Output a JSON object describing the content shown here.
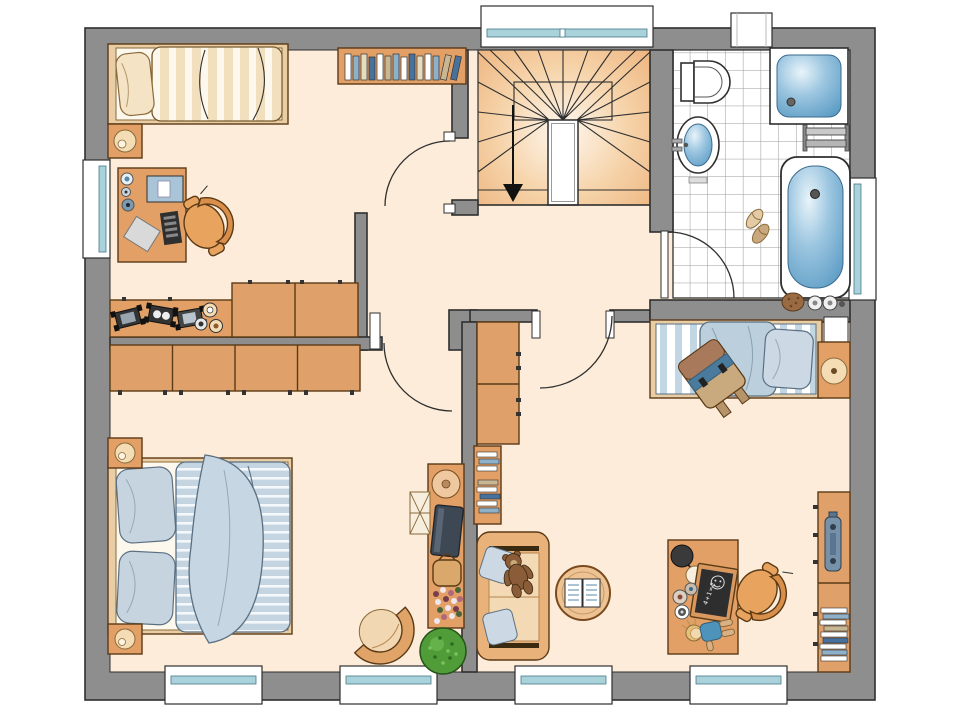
{
  "diagram": {
    "type": "architectural-floor-plan",
    "floor": "upper-floor",
    "chalkboard": {
      "text": "4+1=2"
    },
    "palette": {
      "wall_gray": "#8e8e8e",
      "outline": "#2f2f2f",
      "floor_peach": "#fcecd9",
      "furniture_wood": "#e2a066",
      "wardrobe_wood": "#dfa06a",
      "wood_outline": "#5b3a16",
      "textile_blue": "#c4d4e1",
      "textile_beige": "#f2dfbe",
      "water_blue": "#4e93bf",
      "window_glass": "#a9d2da",
      "stair_orange": "#eaa96f",
      "plant_green": "#4f9c39",
      "chalkboard_black": "#2e2e2e"
    },
    "rooms": {
      "bedroom_top_left": {
        "furniture": [
          "single-bed",
          "pillow",
          "nightstand",
          "lamp",
          "desk",
          "computer-monitor",
          "keyboard",
          "office-chair",
          "wall-bookshelf",
          "toy-sideboard",
          "toy-cars",
          "cabinets"
        ]
      },
      "stair_hall": {
        "furniture": [
          "winder-staircase",
          "stair-landing",
          "direction-arrow-down"
        ]
      },
      "bathroom": {
        "furniture": [
          "toilet",
          "washbasin",
          "shower",
          "towel-radiator",
          "bathtub",
          "slippers",
          "bath-sponge",
          "tap-knobs"
        ]
      },
      "parents_bedroom": {
        "furniture": [
          "double-bed",
          "pillows",
          "duvet",
          "blanket",
          "nightstand",
          "nightstand",
          "lamps",
          "wardrobe-4-door",
          "tv-sideboard",
          "bowl",
          "tv",
          "bag",
          "flowers",
          "side-unit",
          "armchair",
          "plant"
        ]
      },
      "kids_room": {
        "furniture": [
          "single-bed",
          "school-backpack",
          "nightstand",
          "lamp",
          "wall-niche",
          "sofa",
          "cushions",
          "teddy-bear",
          "wall-bookshelf",
          "tall-cabinet",
          "round-side-table",
          "magazines",
          "kids-desk",
          "desk-lamp",
          "chalkboard",
          "paint-pots",
          "doll",
          "desk-chair",
          "shelf-unit",
          "speaker",
          "books"
        ]
      }
    },
    "openings": {
      "doors": 4,
      "windows": 8,
      "stairs_direction": "down"
    }
  }
}
